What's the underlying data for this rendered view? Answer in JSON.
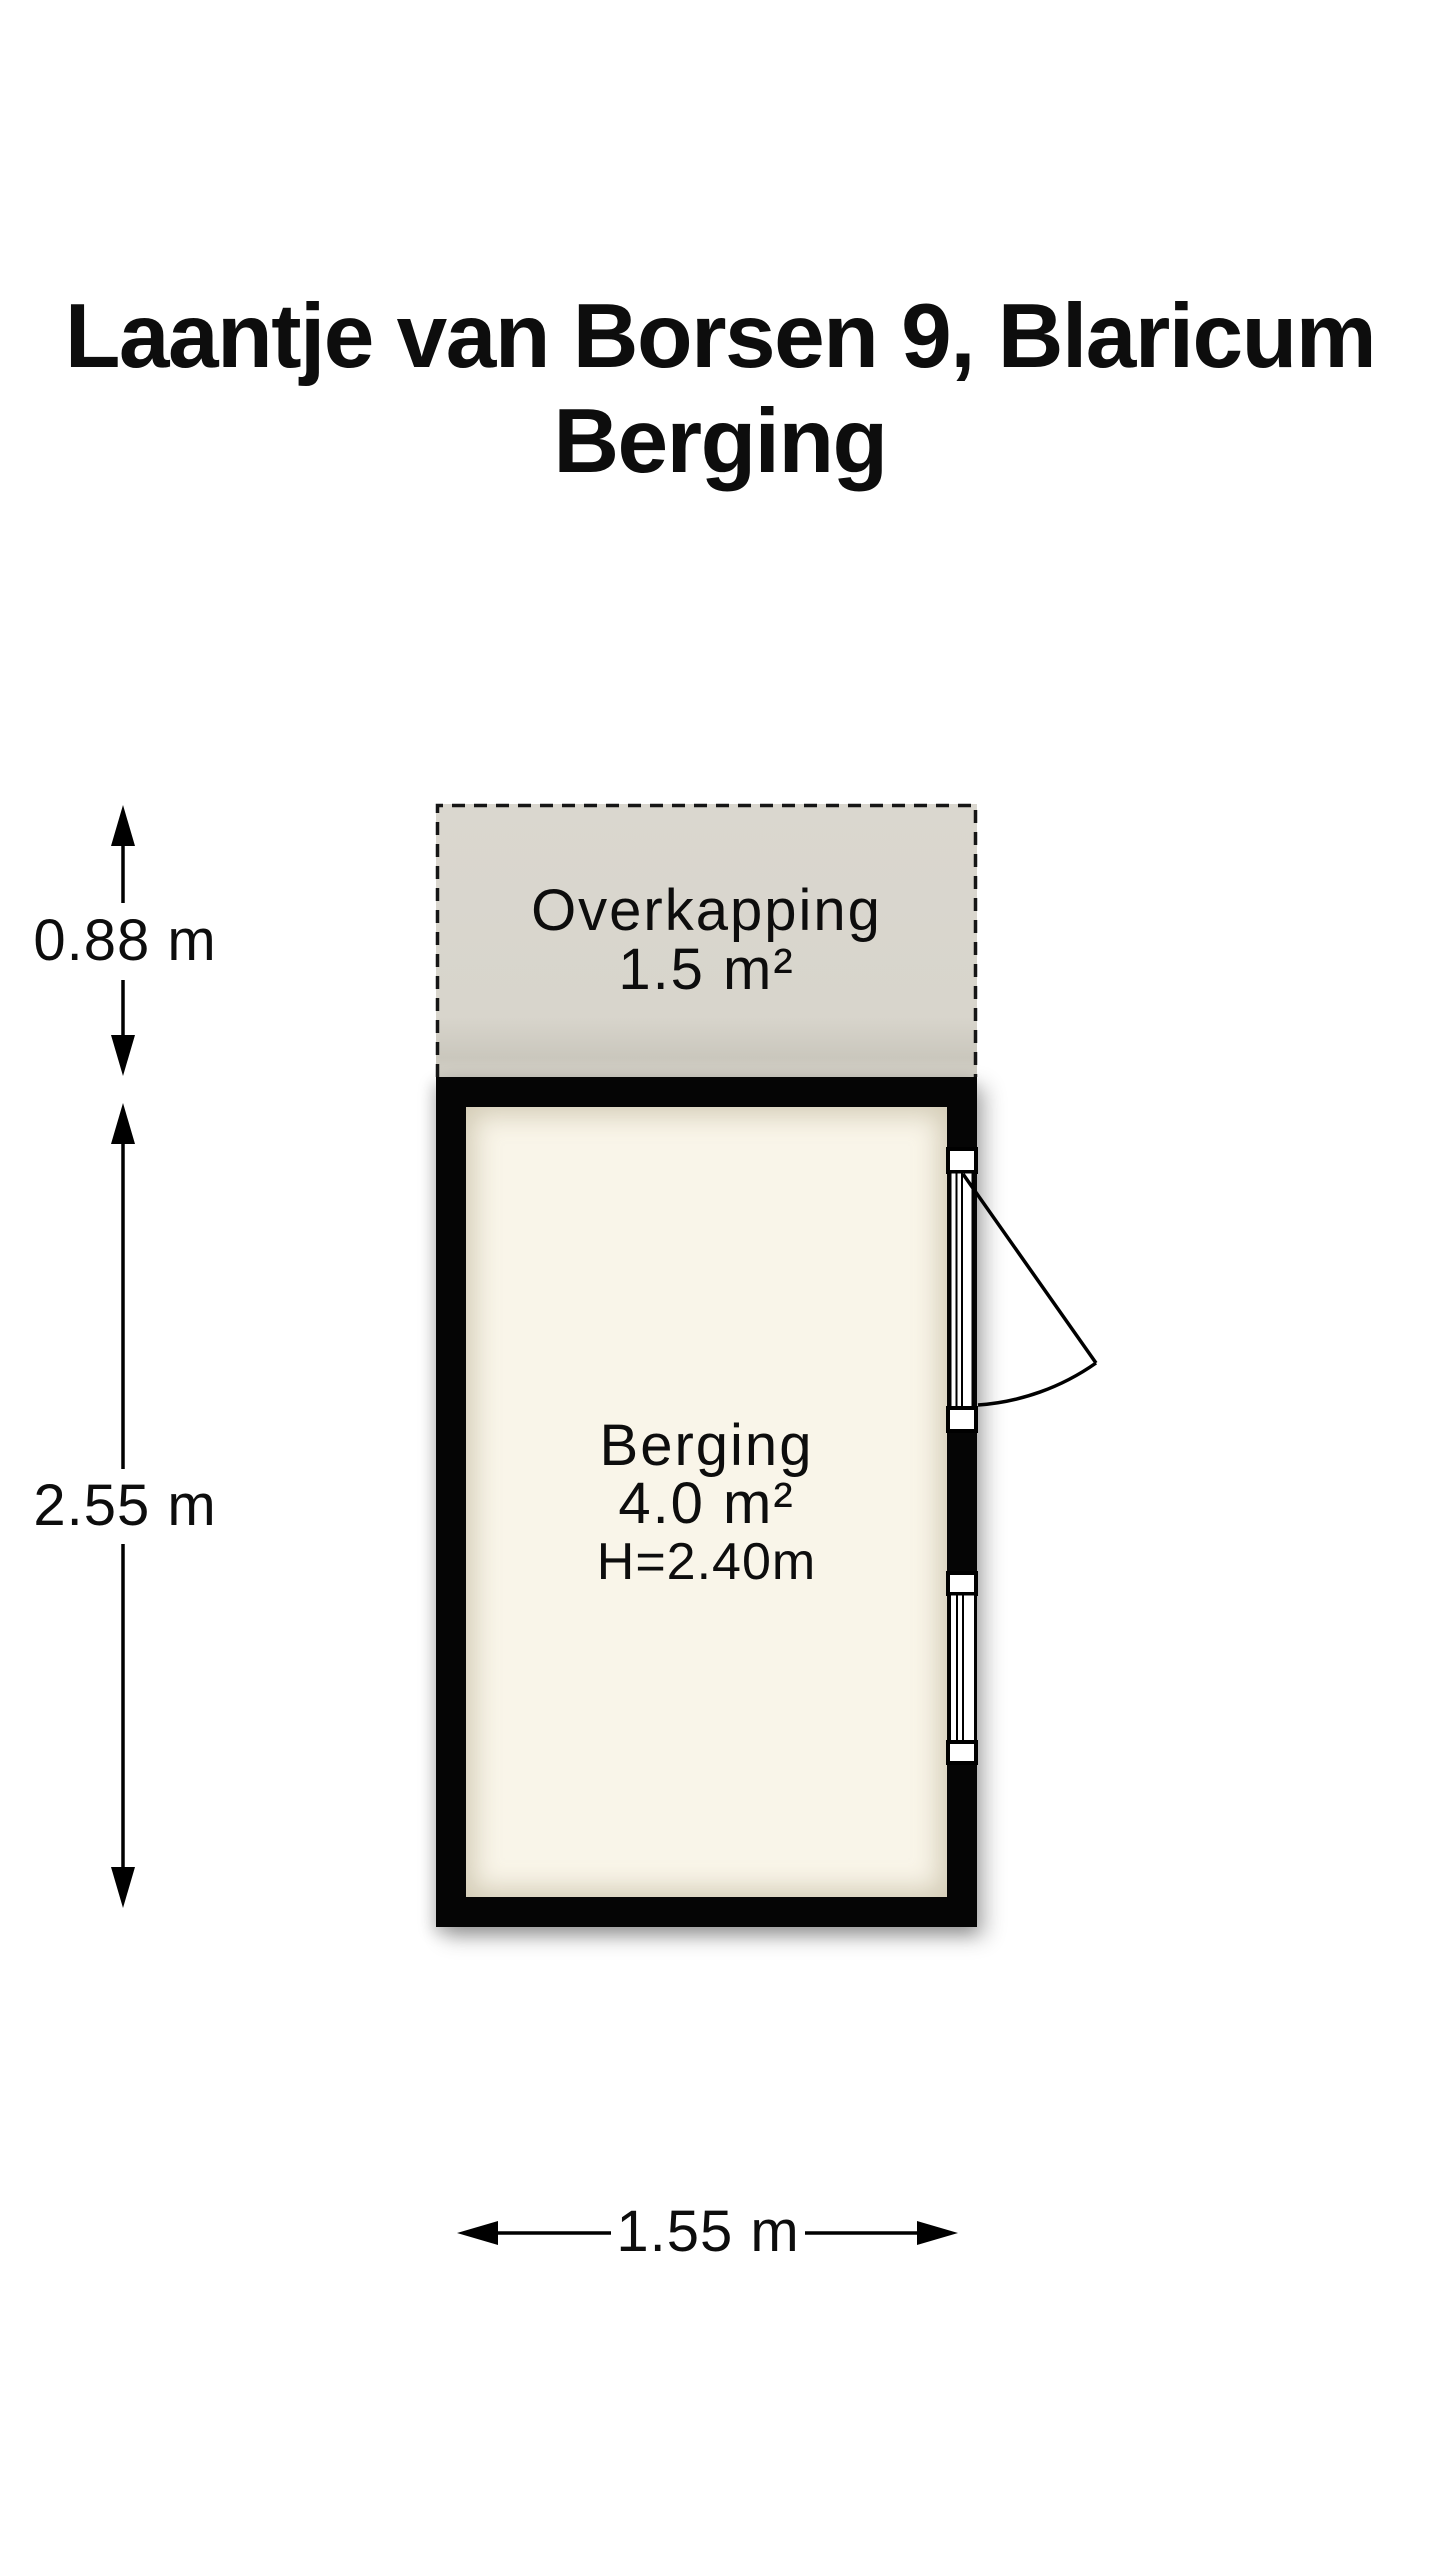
{
  "title": {
    "line1": "Laantje van Borsen 9, Blaricum",
    "line2": "Berging"
  },
  "plan": {
    "overkapping": {
      "label": "Overkapping",
      "area": "1.5 m²"
    },
    "room": {
      "label": "Berging",
      "area": "4.0 m²",
      "ceiling_height": "H=2.40m"
    },
    "dimensions": {
      "overkapping_depth": {
        "label": "0.88 m"
      },
      "room_depth": {
        "label": "2.55 m"
      },
      "width": {
        "label": "1.55 m"
      }
    }
  },
  "colors": {
    "background": "#ffffff",
    "wall": "#050505",
    "floor_fill": "#f9f5e9",
    "overkapping_fill": "#d8d5cc",
    "line": "#000000",
    "text": "#0d0d0d"
  }
}
